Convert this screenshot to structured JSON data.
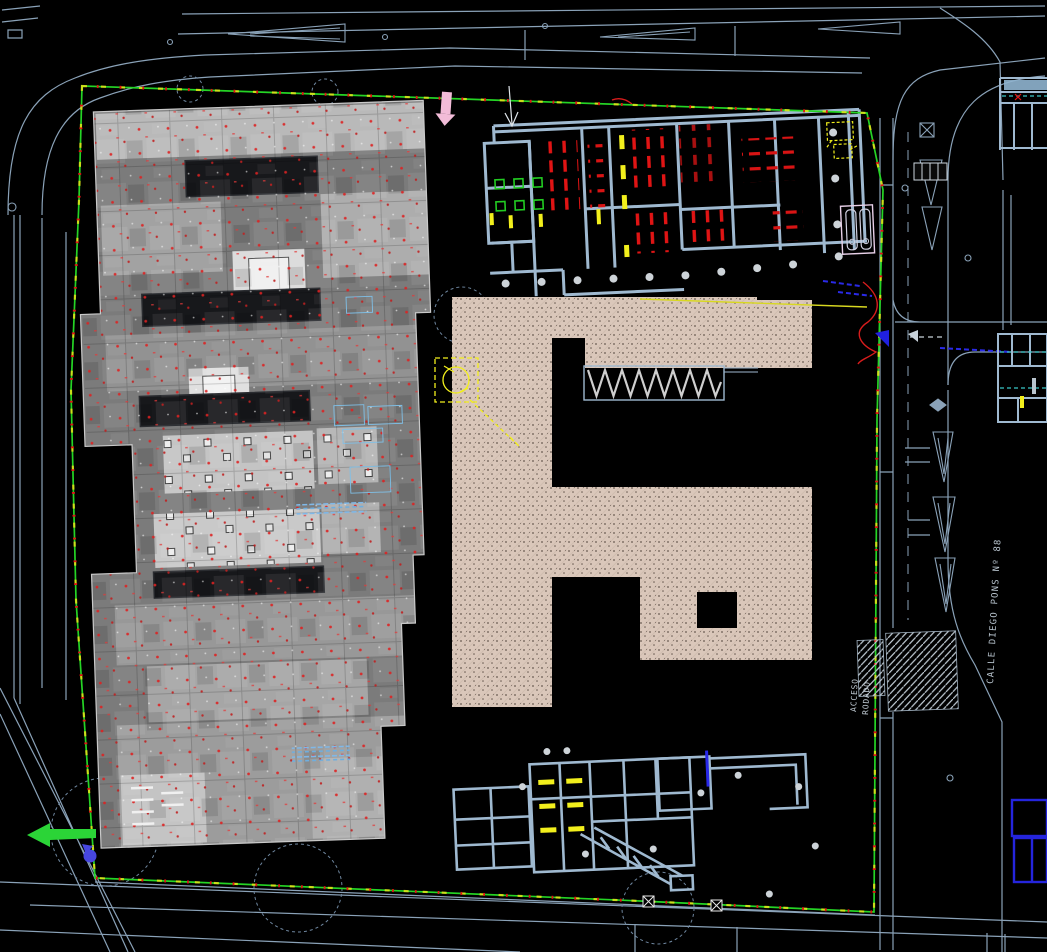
{
  "annotations": {
    "street_label": "CALLE DIEGO PONS Nº 88",
    "access_label_line1": "ACCESO",
    "access_label_line2": "RODADO"
  },
  "colors": {
    "background": "#000000",
    "road_line": "#8aa2b8",
    "wall_line": "#9fb9d0",
    "site_boundary_green": "#25d425",
    "boundary_tick_red": "#e01414",
    "boundary_tick_yellow": "#e8e41a",
    "fixture_red": "#e01414",
    "fixture_dark_red": "#a81010",
    "fixture_green": "#22cc22",
    "fixture_yellow": "#f2ef1c",
    "utility_blue": "#2626e8",
    "cyan_dash": "#38c6c6",
    "courtyard_beige": "#dac7ba",
    "raster_gray": "#8a8a8a",
    "marker_pink": "#f2bcd8",
    "label_gray": "#b8c4ce"
  }
}
